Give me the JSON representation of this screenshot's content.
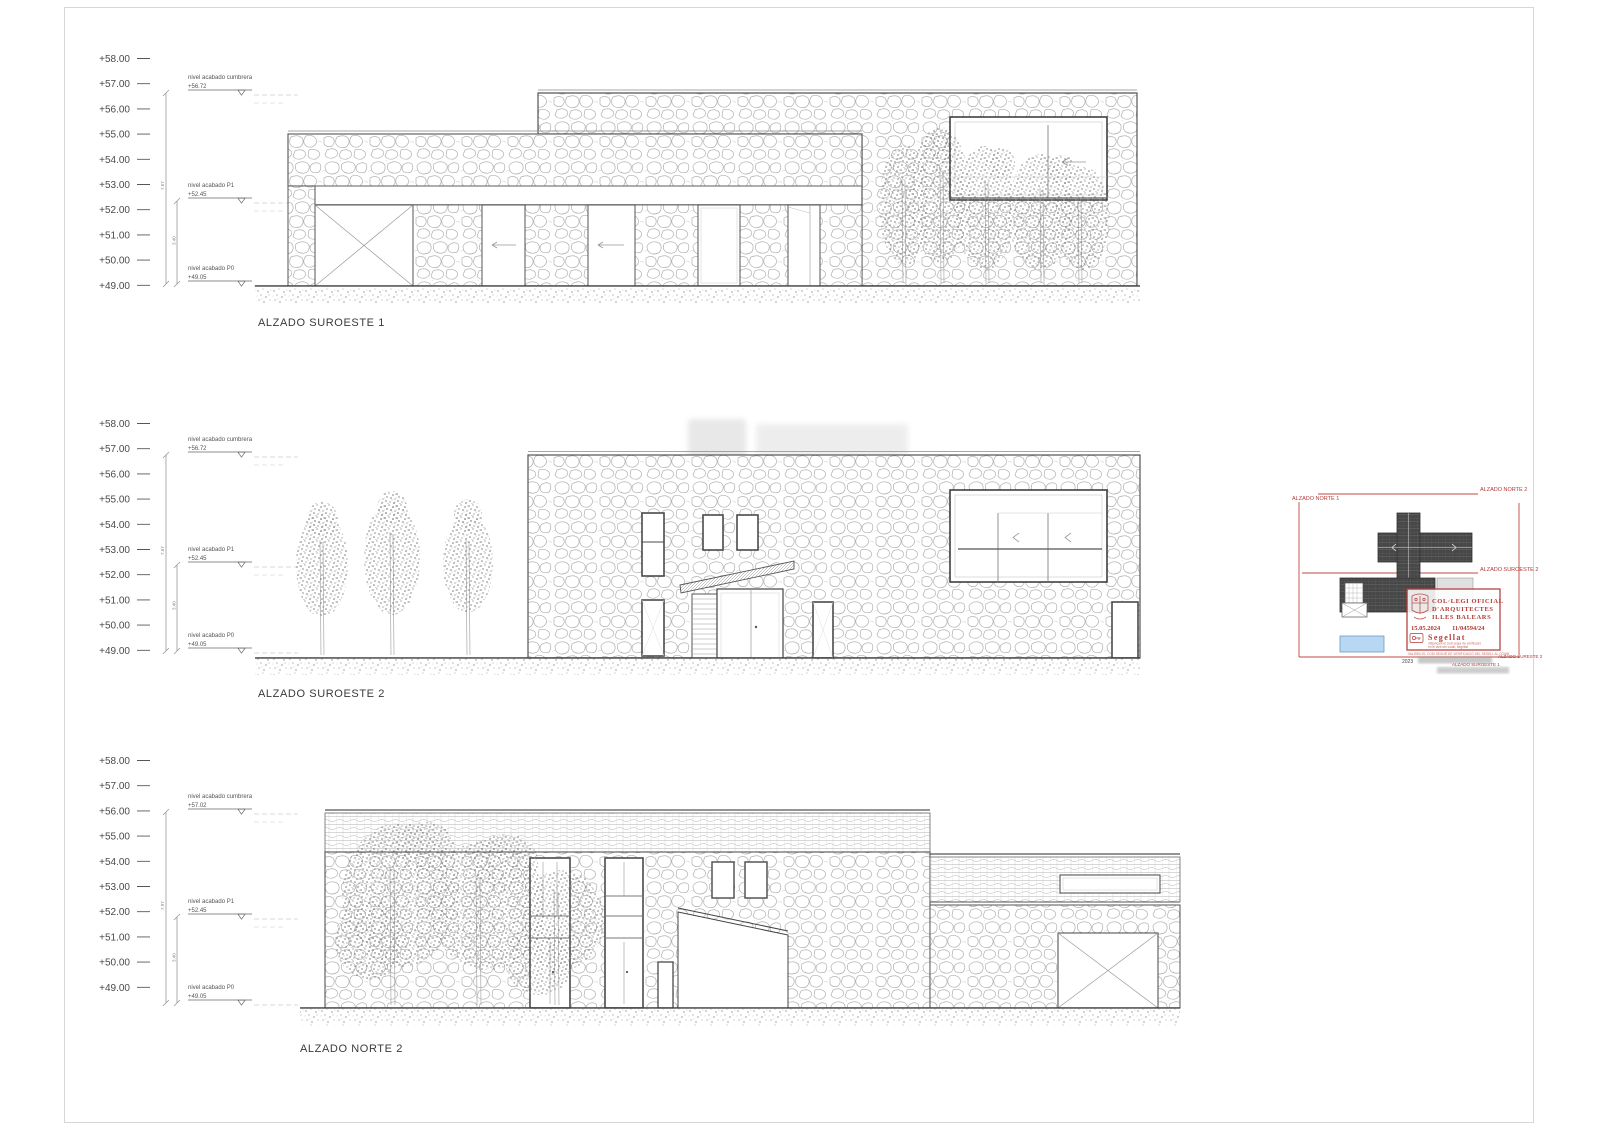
{
  "sheet": {
    "scale_labels": [
      "+58.00",
      "+57.00",
      "+56.00",
      "+55.00",
      "+54.00",
      "+53.00",
      "+52.00",
      "+51.00",
      "+50.00",
      "+49.00"
    ]
  },
  "elevations": [
    {
      "title": "ALZADO SUROESTE 1",
      "levels": {
        "cumbrera_label": "nivel acabado cumbrera",
        "cumbrera_value": "+56.72",
        "p1_label": "nivel acabado P1",
        "p1_value": "+52.45",
        "p0_label": "nivel acabado P0",
        "p0_value": "+49.05"
      },
      "dims": {
        "total": "7.67",
        "partial": "3.40"
      }
    },
    {
      "title": "ALZADO SUROESTE 2",
      "levels": {
        "cumbrera_label": "nivel acabado cumbrera",
        "cumbrera_value": "+56.72",
        "p1_label": "nivel acabado P1",
        "p1_value": "+52.45",
        "p0_label": "nivel acabado P0",
        "p0_value": "+49.05"
      },
      "dims": {
        "total": "7.67",
        "partial": "3.40"
      }
    },
    {
      "title": "ALZADO NORTE 2",
      "levels": {
        "cumbrera_label": "nivel acabado cumbrera",
        "cumbrera_value": "+57.02",
        "p1_label": "nivel acabado P1",
        "p1_value": "+52.45",
        "p0_label": "nivel acabado P0",
        "p0_value": "+49.05"
      },
      "dims": {
        "total": "7.97",
        "partial": "3.40"
      }
    }
  ],
  "key_plan": {
    "labels": {
      "norte1": "ALZADO NORTE 1",
      "norte2": "ALZADO NORTE 2",
      "suroeste2": "ALZADO SUROESTE 2",
      "suroeste1": "ALZADO SUROESTE 1",
      "sureste": "ALZADO SURESTE 2",
      "year": "2023"
    }
  },
  "stamp": {
    "org_line1": "COL·LEGI OFICIAL",
    "org_line2": "D'ARQUITECTES",
    "org_line3": "ILLES BALEARS",
    "date": "15.05.2024",
    "number": "11/04594/24",
    "seal_word": "Segellat",
    "small_line1": "mitjançant el codi segur de verificació",
    "small_line2": "en el web del coaib, segellat",
    "footer": "VALIDEU EL CODI SEGUR DE VERIFICACIÓ DEL SEGELL AL COAIB"
  }
}
